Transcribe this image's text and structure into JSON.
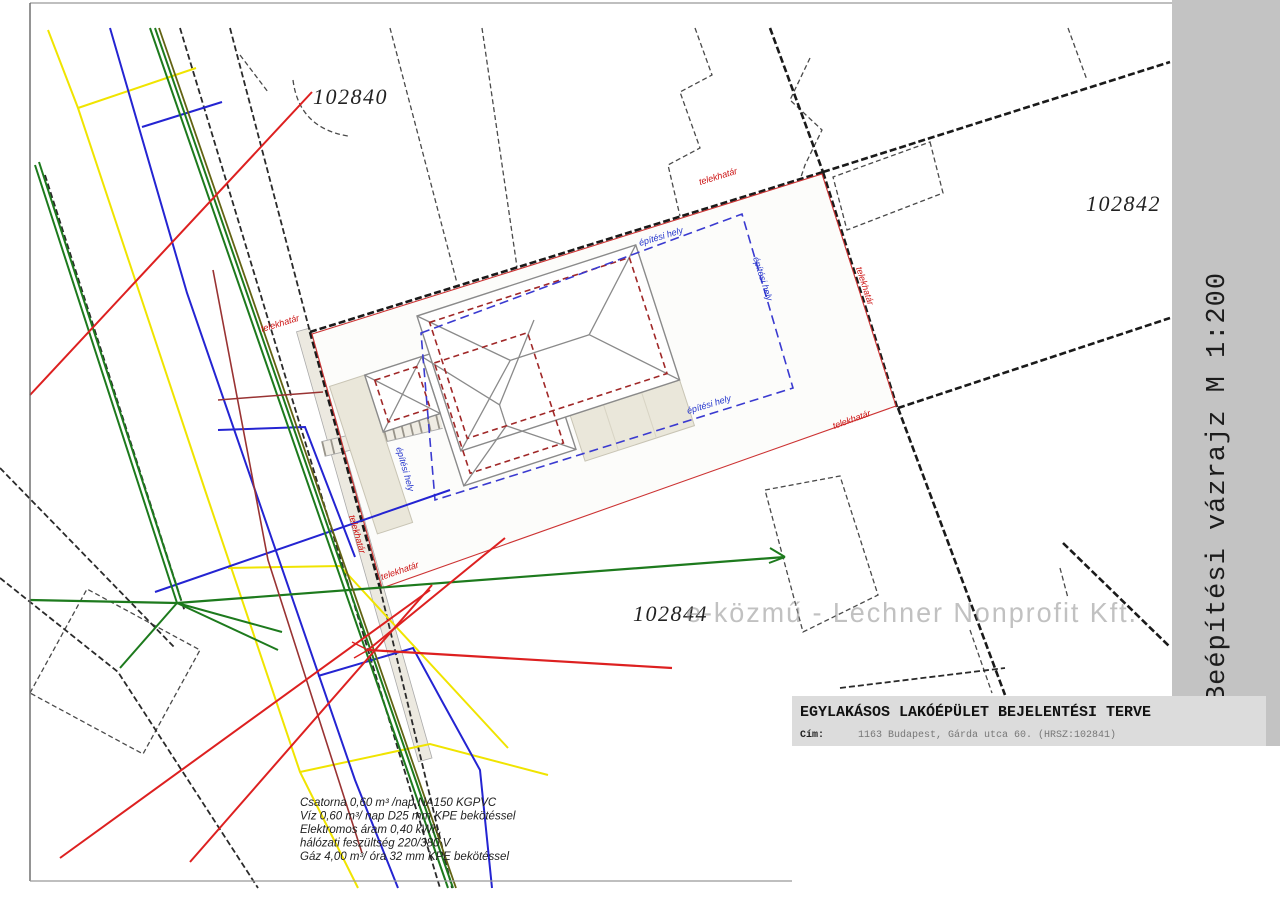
{
  "labels": {
    "parcel_102840": "102840",
    "parcel_102842": "102842",
    "parcel_102844": "102844",
    "telekhatar": "telekhatár",
    "epitesi_hely": "építési hely",
    "watermark": "e-közmű - Lechner Nonprofit Kft."
  },
  "notes": [
    "Csatorna 0,60 m³ /nap NA150 KGPVC",
    "Víz 0,60 m³/ nap D25 mm KPE bekötéssel",
    "Elektromos áram 0,40 kWh,",
    "hálózati feszültség 220/380 V",
    "Gáz 4,00 m³/ óra 32 mm KPE bekötéssel"
  ],
  "side_caption": "Beépítési vázrajz M 1:200",
  "title_block": {
    "title": "EGYLAKÁSOS LAKÓÉPÜLET BEJELENTÉSI TERVE",
    "address_label": "Cím:",
    "address_value": "1163 Budapest, Gárda utca 60. (HRSZ:102841)"
  },
  "colors": {
    "gas_yellow": "#f0e400",
    "water_blue": "#2424d2",
    "sewer_green": "#1d7a1d",
    "electric_red": "#dd2020",
    "telecom_brown": "#993333",
    "boundary_red": "#cc3333",
    "envelope_blue": "#3a3ad0",
    "footprint_red": "#a02828",
    "sidebar_gray": "#c3c3c3",
    "titleblock_gray": "#dcdcdc",
    "paving_beige": "#eae7da"
  }
}
